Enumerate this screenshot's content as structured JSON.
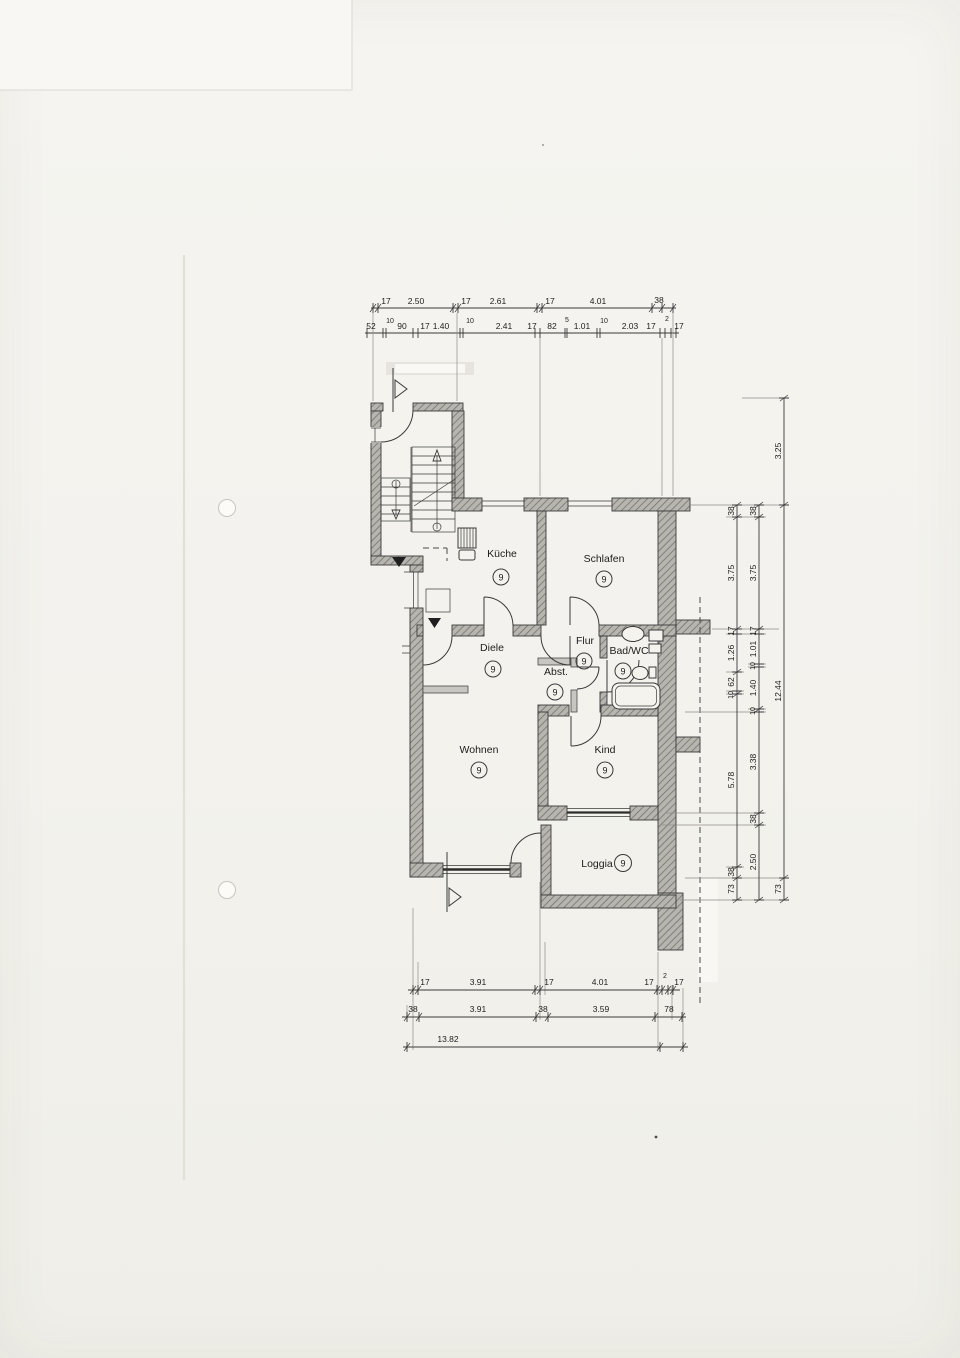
{
  "rooms": {
    "kueche": {
      "label": "Küche",
      "mark": "9"
    },
    "schlafen": {
      "label": "Schlafen",
      "mark": "9"
    },
    "diele": {
      "label": "Diele",
      "mark": "9"
    },
    "flur": {
      "label": "Flur",
      "mark": "9"
    },
    "abst": {
      "label": "Abst.",
      "mark": "9"
    },
    "bad_wc": {
      "label": "Bad/WC",
      "mark": "9"
    },
    "wohnen": {
      "label": "Wohnen",
      "mark": "9"
    },
    "kind": {
      "label": "Kind",
      "mark": "9"
    },
    "loggia": {
      "label": "Loggia",
      "mark": "9"
    }
  },
  "dims": {
    "top_row1": [
      "17",
      "2.50",
      "17",
      "2.61",
      "17",
      "4.01",
      "38"
    ],
    "top_row2": [
      "52",
      "10",
      "90",
      "17",
      "1.40",
      "10",
      "2.41",
      "17",
      "82",
      "5",
      "1.01",
      "10",
      "2.03",
      "17",
      "2",
      "17"
    ],
    "right_inner": [
      "38",
      "3.75",
      "17",
      "1.26",
      "62",
      "10",
      "5.78",
      "38",
      "73"
    ],
    "right_middle": [
      "38",
      "3.75",
      "17",
      "1.01",
      "10",
      "1.40",
      "10",
      "3.38",
      "38",
      "2.50"
    ],
    "right_outer": [
      "3.25",
      "12.44",
      "73"
    ],
    "bottom_row1": [
      "17",
      "3.91",
      "17",
      "4.01",
      "17",
      "2",
      "17"
    ],
    "bottom_row2": [
      "38",
      "3.91",
      "38",
      "3.59",
      "78"
    ],
    "bottom_total": "13.82"
  }
}
